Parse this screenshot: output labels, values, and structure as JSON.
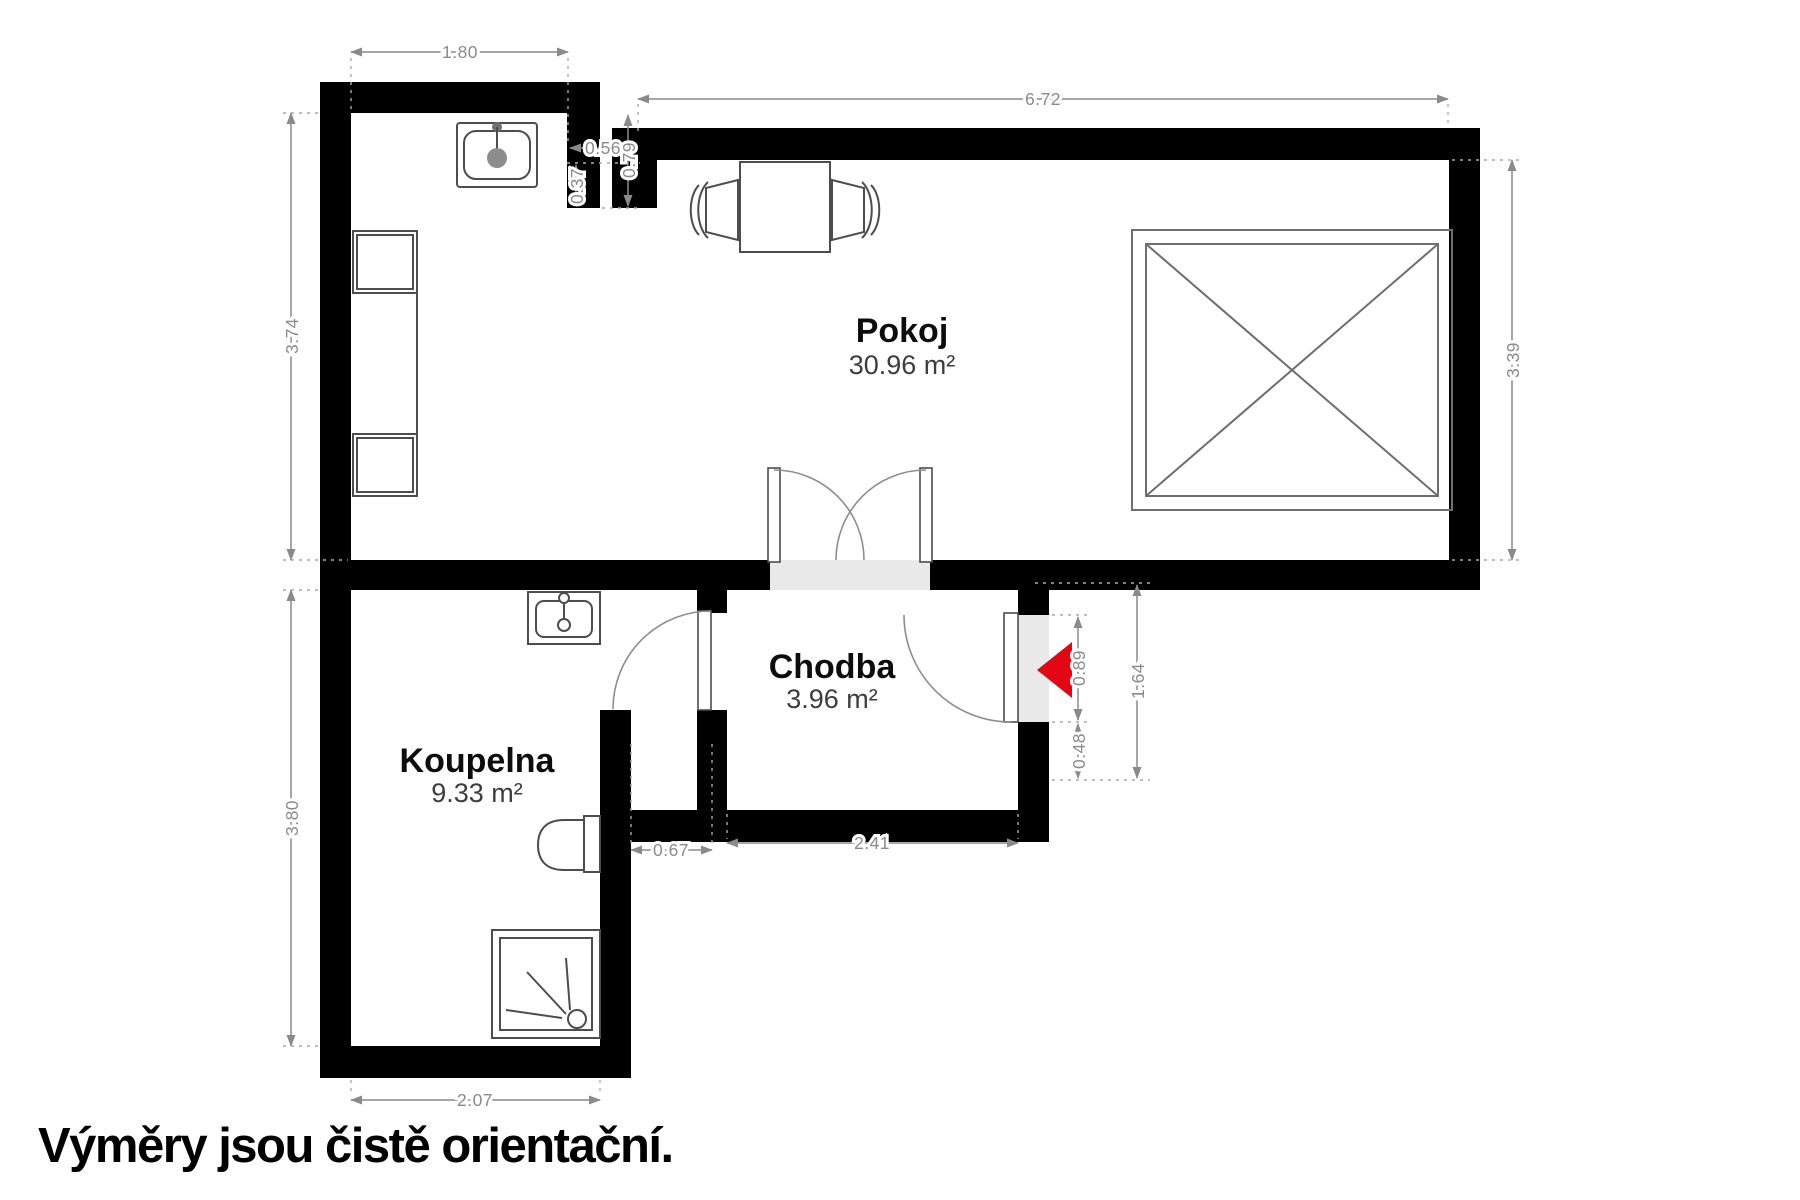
{
  "caption": "Výměry jsou čistě orientační.",
  "rooms": {
    "pokoj": {
      "name": "Pokoj",
      "area": "30.96 m²"
    },
    "chodba": {
      "name": "Chodba",
      "area": "3.96 m²"
    },
    "koupelna": {
      "name": "Koupelna",
      "area": "9.33 m²"
    }
  },
  "dimensions": {
    "kitchen_top_width": "1.80",
    "pokoj_top_width": "6.72",
    "pokoj_left_height": "3.74",
    "pokoj_right_height": "3.39",
    "niche_width": "0.56",
    "niche_depth": "0.79",
    "pier_depth": "0.37",
    "koupelna_left_height": "3.80",
    "koupelna_bottom_width": "2.07",
    "passage_width": "0.67",
    "chodba_width": "2.41",
    "entry_door_height": "0.89",
    "entry_wall_stub": "0.48",
    "entry_total_height": "1.64"
  },
  "symbols": {
    "kitchen_sink": "kitchen-sink-icon",
    "counter_units": "kitchen-unit-icons",
    "dining_table": "dining-table-icon",
    "chairs": "chair-icons",
    "bed": "bed-icon",
    "washbasin": "washbasin-icon",
    "toilet": "toilet-icon",
    "shower": "shower-icon",
    "entrance_arrow": "entrance-arrow-icon"
  },
  "colors": {
    "wall": "#000000",
    "dimension_gray": "#8a8a8a",
    "threshold_gray": "#e9e9e9",
    "entrance_arrow_red": "#e30613",
    "background": "#ffffff"
  }
}
